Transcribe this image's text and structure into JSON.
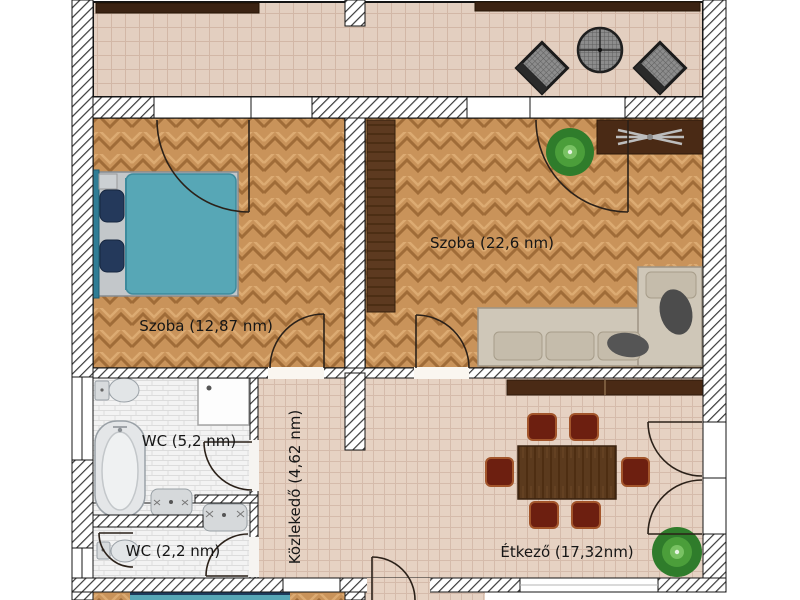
{
  "rooms": {
    "bedroom": {
      "label": "Szoba (12,87 nm)"
    },
    "living_room": {
      "label": "Szoba (22,6 nm)"
    },
    "bathroom": {
      "label": "WC (5,2 nm)"
    },
    "wc": {
      "label": "WC (2,2 nm)"
    },
    "hallway": {
      "label": "Közlekedő (4,62 nm)"
    },
    "dining_room": {
      "label": "Étkező (17,32nm)"
    }
  },
  "colors": {
    "bed_blanket": "#57a7b6",
    "bed_headboard": "#2f7d95",
    "bed_pillow": "#24395b",
    "sofa_body": "#cfc7b8",
    "dining_chair": "#6d1f10",
    "dining_table": "#5b3a1d",
    "dark_wood": "#4a2a15",
    "railing": "#3b2313",
    "parquet": "#c9935a",
    "terrace_tile": "#e3cfc0",
    "hall_tile": "#e6d2c3",
    "plant": "#2f7c2b",
    "wall_hatch": "#3a3a3a"
  },
  "furniture": {
    "terrace": [
      "railing",
      "wicker-chair",
      "round-mesh-table",
      "wicker-chair"
    ],
    "bedroom": [
      "double-bed"
    ],
    "living_room": [
      "wardrobe",
      "cabinet-with-fan",
      "plant",
      "corner-sofa"
    ],
    "bathroom": [
      "toilet",
      "shower",
      "bathtub",
      "sink"
    ],
    "wc": [
      "toilet",
      "sink"
    ],
    "dining_room": [
      "sideboard",
      "dining-table",
      "six-chairs",
      "plant"
    ]
  }
}
